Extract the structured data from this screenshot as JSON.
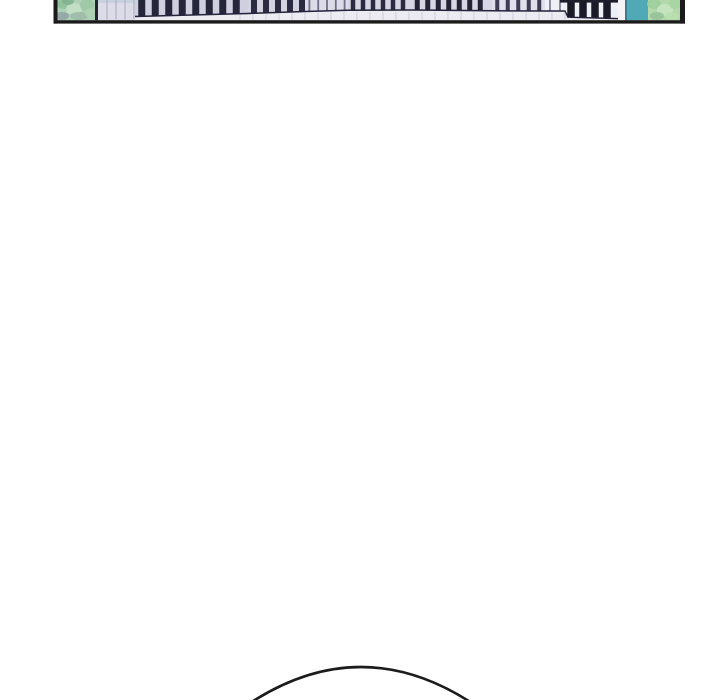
{
  "page": {
    "background_color": "#ffffff",
    "width": 720,
    "height": 700
  },
  "panel": {
    "description_colors": {
      "ink": "#1b1b1b",
      "facade_lavender": "#dcdce8",
      "soffit": "#ebebf2",
      "teal_glass": "#4fa9b6",
      "tree_mint": "#aed0b5"
    },
    "interior": {
      "x0": 57.5,
      "x1": 680,
      "y_bottom": 20.2
    },
    "border": {
      "color": "#1b1b1b",
      "left": {
        "x": 53.5,
        "w": 4
      },
      "right": {
        "x": 680,
        "w": 5
      },
      "bottom": {
        "y": 20.2,
        "h": 3.4
      }
    },
    "soffit": {
      "color": "#ebebf2",
      "tick_color": "#c4c4d4",
      "tick_x0": 240,
      "tick_x1": 614,
      "tick_step": 13
    },
    "facade": {
      "x0": 98,
      "x1": 135,
      "color": "#dcdce8",
      "line_color": "#a9a9bd",
      "line_step": 9,
      "top_band_h": 3,
      "top_band_color": "#c7d1e0"
    },
    "edge_line": {
      "x": 95,
      "w": 3,
      "color": "#23232f"
    },
    "tree_left": {
      "x0": 57.5,
      "x1": 95,
      "base": "#aed0b5",
      "blobs": [
        [
          64,
          4,
          8,
          5,
          "#8fbf9b"
        ],
        [
          74,
          9,
          8,
          6,
          "#c6e2c9"
        ],
        [
          87,
          5,
          7,
          6,
          "#9cc7a5"
        ],
        [
          62,
          16,
          7,
          4,
          "#8fa2a6"
        ],
        [
          79,
          16,
          9,
          4,
          "#9db8a8"
        ],
        [
          90,
          13,
          5,
          5,
          "#add2b2"
        ],
        [
          68,
          1,
          6,
          4,
          "#7fb28f"
        ]
      ]
    },
    "sliver": {
      "x0": 618,
      "x1": 625,
      "color": "#f3f3f7"
    },
    "glass": {
      "x0": 625,
      "x1": 648,
      "color": "#4fa9b6",
      "edge_color": "#377d8b",
      "edge_w": 2
    },
    "tree_right": {
      "x0": 648,
      "x1": 680,
      "base": "#b2d8ac",
      "blobs": [
        [
          654,
          4,
          7,
          5,
          "#9ccf9a"
        ],
        [
          665,
          10,
          8,
          6,
          "#c8e6bf"
        ],
        [
          675,
          4,
          6,
          5,
          "#a5d6a0"
        ],
        [
          657,
          16,
          7,
          4,
          "#93c298"
        ],
        [
          672,
          16,
          7,
          4,
          "#b8dfae"
        ]
      ]
    },
    "top_band": {
      "x0": 560,
      "x1": 618,
      "h": 2.6,
      "color": "#1d1d2b"
    },
    "slat_groups": [
      {
        "x0": 135,
        "x1": 248,
        "bar": 7,
        "gap": 6.5,
        "color": "#26263a",
        "bg": "#cfcfdf",
        "yL": 16.5,
        "yR": 13.5
      },
      {
        "x0": 248,
        "x1": 305,
        "bar": 6,
        "gap": 6,
        "color": "#2b2b41",
        "bg": "#d2d2e0",
        "yL": 13.5,
        "yR": 11.5
      },
      {
        "x0": 305,
        "x1": 348,
        "bar": 1.8,
        "gap": 7,
        "color": "#6f6f8a",
        "bg": "#dcdce8",
        "yL": 11.5,
        "yR": 10.3
      },
      {
        "x0": 348,
        "x1": 412,
        "bar": 4.5,
        "gap": 5.5,
        "color": "#2a2a40",
        "bg": "#d6d6e4",
        "yL": 10.3,
        "yR": 10
      },
      {
        "x0": 412,
        "x1": 492,
        "bar": 5,
        "gap": 5.5,
        "color": "#242436",
        "bg": "#d6d6e4",
        "yL": 10,
        "yR": 10.8
      },
      {
        "x0": 492,
        "x1": 545,
        "bar": 4,
        "gap": 6.5,
        "color": "#3c3c54",
        "bg": "#e0e0ec",
        "yL": 10.8,
        "yR": 11
      },
      {
        "x0": 545,
        "x1": 565,
        "bar": 2,
        "gap": 8,
        "color": "#8a8aa2",
        "bg": "#eef0f6",
        "yL": 11,
        "yR": 11
      },
      {
        "x0": 565,
        "x1": 618,
        "bar": 7.5,
        "gap": 4.5,
        "color": "#1a1a28",
        "bg": "#eef0f8",
        "yL": 17.2,
        "yR": 18.6
      }
    ],
    "rail": {
      "color": "#23233a",
      "width": 1.5,
      "points": [
        [
          135,
          16.5
        ],
        [
          248,
          13.5
        ],
        [
          305,
          11.5
        ],
        [
          348,
          10.3
        ],
        [
          412,
          10
        ],
        [
          492,
          10.8
        ],
        [
          545,
          11
        ],
        [
          565,
          11
        ],
        [
          568,
          17.2
        ],
        [
          618,
          18.6
        ]
      ]
    }
  },
  "head_outline": {
    "path": "M 252.5 701.5 Q 361 632.5 469.5 701.5",
    "color": "#1c1c1c",
    "width": 2.6
  }
}
